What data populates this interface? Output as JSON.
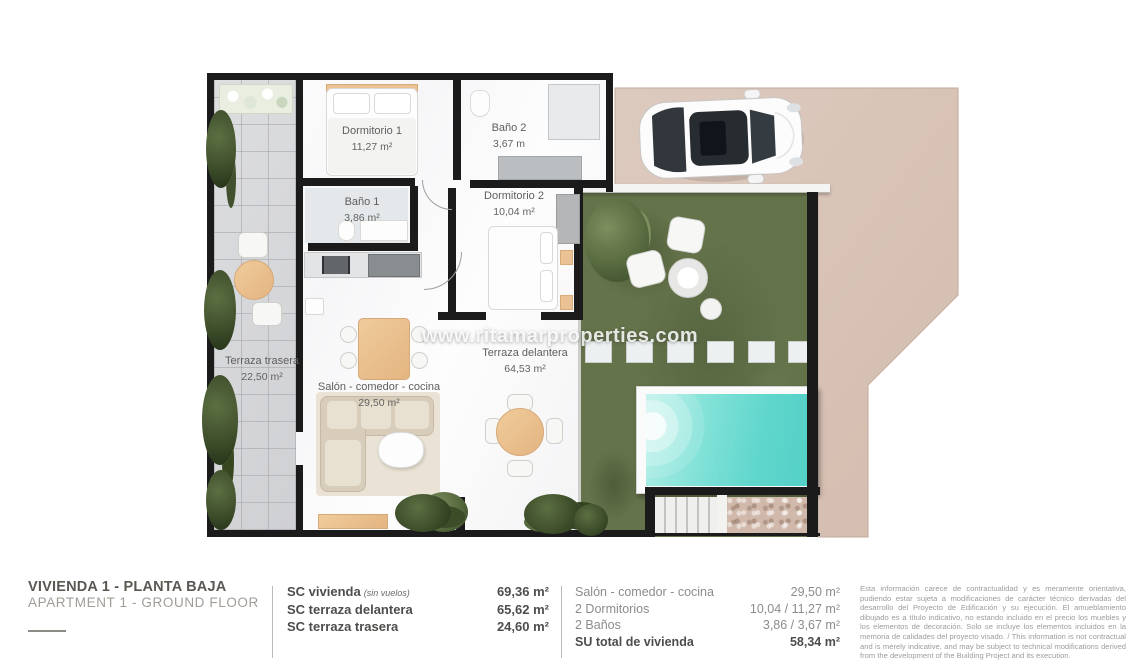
{
  "watermark": "www.ritamarproperties.com",
  "plan": {
    "rooms": [
      {
        "label": "Dormitorio 1",
        "area": "11,27 m²"
      },
      {
        "label": "Baño 2",
        "area": "3,67 m"
      },
      {
        "label": "Dormitorio 2",
        "area": "10,04 m²"
      },
      {
        "label": "Baño 1",
        "area": "3,86 m²"
      },
      {
        "label": "Terraza trasera",
        "area": "22,50 m²"
      },
      {
        "label": "Salón - comedor - cocina",
        "area": "29,50 m²"
      },
      {
        "label": "Terraza delantera",
        "area": "64,53 m²"
      }
    ]
  },
  "footer": {
    "title_es": "VIVIENDA 1 - PLANTA BAJA",
    "title_en": "APARTMENT 1 - GROUND FLOOR",
    "sc_rows": [
      {
        "label": "SC vivienda",
        "note": "(sin vuelos)",
        "value": "69,36 m²"
      },
      {
        "label": "SC terraza delantera",
        "note": "",
        "value": "65,62 m²"
      },
      {
        "label": "SC terraza trasera",
        "note": "",
        "value": "24,60 m²"
      }
    ],
    "su_rows": [
      {
        "label": "Salón - comedor - cocina",
        "value": "29,50 m²"
      },
      {
        "label": "2 Dormitorios",
        "value": "10,04 / 11,27 m²"
      },
      {
        "label": "2 Baños",
        "value": "3,86 / 3,67 m²"
      },
      {
        "label": "SU total de vivienda",
        "value": "58,34 m²"
      }
    ],
    "disclaimer": "Esta información carece de contractualidad y es meramente orientativa, pudiendo estar sujeta a modificaciones de carácter técnico derivadas del desarrollo del Proyecto de Edificación y su ejecución. El amueblamiento dibujado es a título indicativo, no estando incluido en el precio los muebles y los elementos de decoración. Solo se incluye los elementos incluidos en la memoria de calidades del proyecto visado. / This information is not contractual and is merely indicative, and may be subject to technical modifications derived from the development of the Building Project and its execution."
  },
  "colors": {
    "wall": "#1b1b1b",
    "paved": "#d8c4b8",
    "grass": "#64734a",
    "pool_water": "#5fd6cc",
    "tile": "#d4d5d8",
    "wood_accent": "#e9c093",
    "text_dark": "#4f4d4b",
    "text_gray": "#8e8c8a"
  }
}
